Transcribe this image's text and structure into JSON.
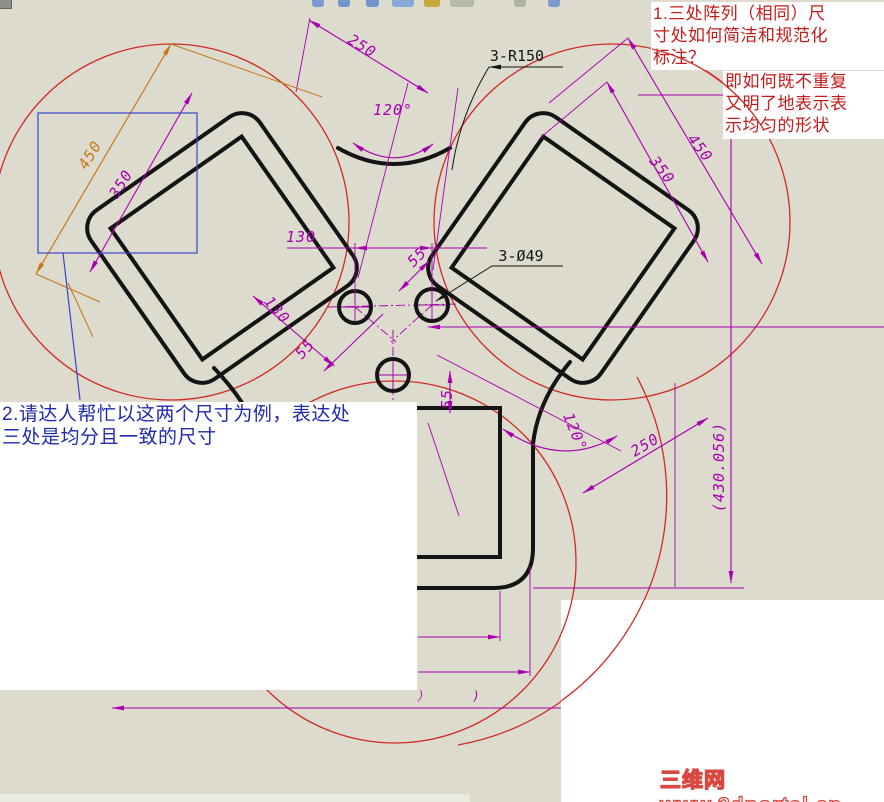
{
  "colors": {
    "background": "#dcdbce",
    "dimension_magenta": "#a800ae",
    "selected_dimension_orange": "#c87818",
    "construction_red": "#cf2b25",
    "annotation_red": "#c41a1a",
    "annotation_blue": "#1f2bb0",
    "part_outline_black": "#141414",
    "selection_box_blue": "#3a46c8"
  },
  "notes": {
    "note1_main": "1.三处阵列（相同）尺\n寸处如何简洁和规范化\n标注？",
    "note1_sub": "即如何既不重复\n又明了地表示表\n示均匀的形状",
    "note2": "2.请达人帮忙以这两个尺寸为例，表达处\n三处是均分且一致的尺寸"
  },
  "watermark": "三维网www.3dportal.cn",
  "dimensions": [
    {
      "t": "250",
      "x": 362,
      "y": 46,
      "r": 32
    },
    {
      "t": "3-R150",
      "x": 517,
      "y": 56,
      "r": 0,
      "c": "blk"
    },
    {
      "t": "120°",
      "x": 393,
      "y": 110,
      "r": 0
    },
    {
      "t": "130",
      "x": 301,
      "y": 237,
      "r": 0
    },
    {
      "t": "55",
      "x": 417,
      "y": 257,
      "r": -45
    },
    {
      "t": "3-Ø49",
      "x": 521,
      "y": 256,
      "r": 0,
      "c": "blk"
    },
    {
      "t": "130",
      "x": 277,
      "y": 310,
      "r": 49
    },
    {
      "t": "55",
      "x": 305,
      "y": 349,
      "r": -48
    },
    {
      "t": "55",
      "x": 447,
      "y": 399,
      "r": -90
    },
    {
      "t": "450",
      "x": 90,
      "y": 155,
      "r": -58,
      "c": "org"
    },
    {
      "t": "350",
      "x": 121,
      "y": 184,
      "r": -58
    },
    {
      "t": "450",
      "x": 700,
      "y": 148,
      "r": 52
    },
    {
      "t": "350",
      "x": 662,
      "y": 170,
      "r": 52
    },
    {
      "t": "120°",
      "x": 575,
      "y": 432,
      "r": 68
    },
    {
      "t": "250",
      "x": 645,
      "y": 445,
      "r": -31
    },
    {
      "t": "(430.056)",
      "x": 719,
      "y": 467,
      "r": -90
    },
    {
      "t": "）",
      "x": 423,
      "y": 696,
      "r": 0,
      "c": "sm"
    },
    {
      "t": ")",
      "x": 476,
      "y": 696,
      "r": 0,
      "c": "sm"
    }
  ],
  "toolbar_fragments": [
    {
      "x": 312,
      "w": 12,
      "color": "#7a9cd0"
    },
    {
      "x": 338,
      "w": 12,
      "color": "#6f95cc"
    },
    {
      "x": 366,
      "w": 13,
      "color": "#6f95cc"
    },
    {
      "x": 392,
      "w": 22,
      "color": "#86a8d8"
    },
    {
      "x": 424,
      "w": 16,
      "color": "#c8a83c"
    },
    {
      "x": 450,
      "w": 24,
      "color": "#b8b8a8"
    },
    {
      "x": 514,
      "w": 12,
      "color": "#b0b0a4"
    },
    {
      "x": 548,
      "w": 12,
      "color": "#7a9cd0"
    }
  ]
}
